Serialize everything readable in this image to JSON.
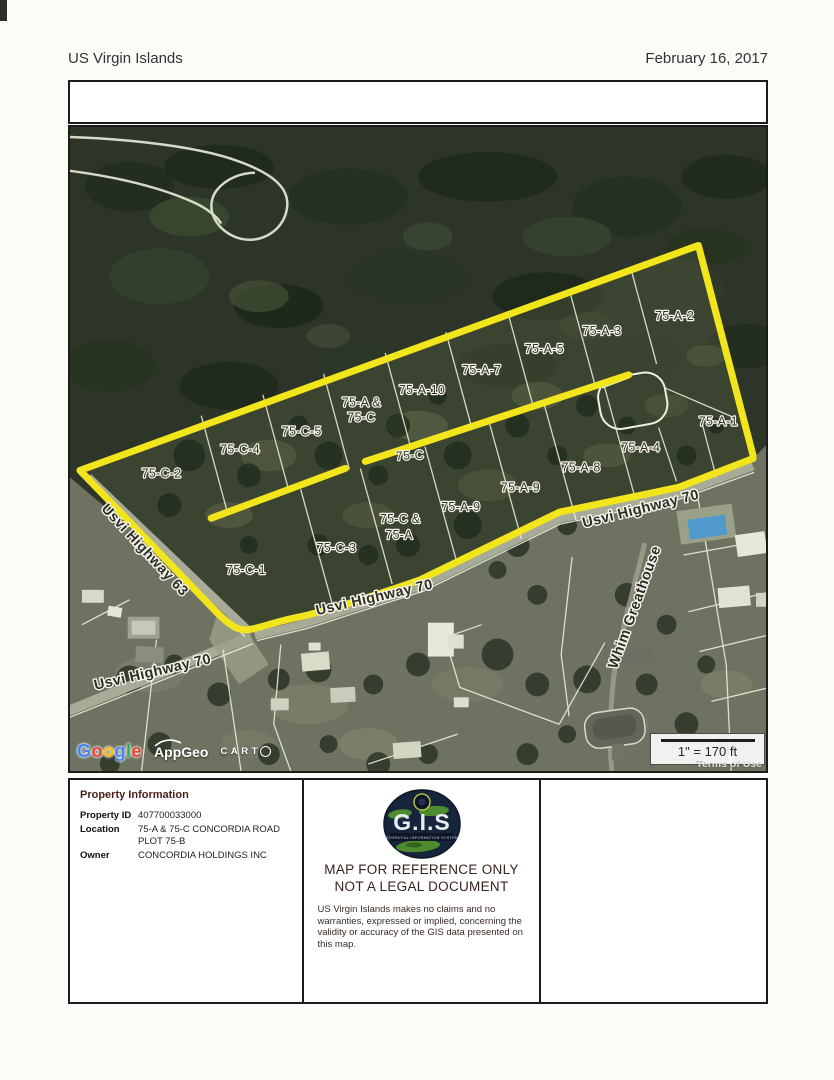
{
  "header": {
    "left": "US Virgin Islands",
    "right": "February 16, 2017"
  },
  "map": {
    "labels": [
      {
        "type": "parcel",
        "text": "75-C-2",
        "x": 92,
        "y": 352,
        "rot": 0
      },
      {
        "type": "parcel",
        "text": "75-C-4",
        "x": 171,
        "y": 328,
        "rot": 0
      },
      {
        "type": "parcel",
        "text": "75-C-5",
        "x": 233,
        "y": 310,
        "rot": 0
      },
      {
        "type": "parcel",
        "text": "75-A &",
        "x": 293,
        "y": 281,
        "rot": 0
      },
      {
        "type": "parcel",
        "text": "75-C",
        "x": 293,
        "y": 296,
        "rot": 0
      },
      {
        "type": "parcel",
        "text": "75-A-10",
        "x": 354,
        "y": 268,
        "rot": 0
      },
      {
        "type": "parcel",
        "text": "75-A-7",
        "x": 414,
        "y": 248,
        "rot": 0
      },
      {
        "type": "parcel",
        "text": "75-A-5",
        "x": 477,
        "y": 227,
        "rot": 0
      },
      {
        "type": "parcel",
        "text": "75-A-3",
        "x": 535,
        "y": 209,
        "rot": 0
      },
      {
        "type": "parcel",
        "text": "75-A-2",
        "x": 608,
        "y": 194,
        "rot": 0
      },
      {
        "type": "parcel",
        "text": "75-A-1",
        "x": 652,
        "y": 300,
        "rot": 0
      },
      {
        "type": "parcel",
        "text": "75-C",
        "x": 342,
        "y": 334,
        "rot": -3
      },
      {
        "type": "parcel",
        "text": "75-C-1",
        "x": 177,
        "y": 449,
        "rot": 0
      },
      {
        "type": "parcel",
        "text": "75-C-3",
        "x": 268,
        "y": 427,
        "rot": 0
      },
      {
        "type": "parcel",
        "text": "75-C &",
        "x": 332,
        "y": 398,
        "rot": 0
      },
      {
        "type": "parcel",
        "text": "75-A",
        "x": 331,
        "y": 414,
        "rot": 0
      },
      {
        "type": "parcel",
        "text": "75-A-9",
        "x": 393,
        "y": 386,
        "rot": 0
      },
      {
        "type": "parcel",
        "text": "75-A-9",
        "x": 453,
        "y": 366,
        "rot": 0
      },
      {
        "type": "parcel",
        "text": "75-A-8",
        "x": 514,
        "y": 346,
        "rot": 0
      },
      {
        "type": "parcel",
        "text": "75-A-4",
        "x": 574,
        "y": 326,
        "rot": 0
      },
      {
        "type": "road",
        "text": "Usvi Highway 63",
        "x": 72,
        "y": 428,
        "rot": 47
      },
      {
        "type": "road",
        "text": "Usvi Highway 70",
        "x": 575,
        "y": 388,
        "rot": -14
      },
      {
        "type": "road",
        "text": "Usvi Highway 70",
        "x": 307,
        "y": 477,
        "rot": -13
      },
      {
        "type": "road",
        "text": "Usvi Highway 70",
        "x": 84,
        "y": 552,
        "rot": -13
      },
      {
        "type": "road",
        "text": "Whim Greathouse",
        "x": 572,
        "y": 484,
        "rot": -70
      }
    ],
    "attribution": {
      "google_letters": [
        {
          "ch": "G",
          "c": "#4285F4"
        },
        {
          "ch": "o",
          "c": "#EA4335"
        },
        {
          "ch": "o",
          "c": "#FBBC05"
        },
        {
          "ch": "g",
          "c": "#4285F4"
        },
        {
          "ch": "l",
          "c": "#34A853"
        },
        {
          "ch": "e",
          "c": "#EA4335"
        }
      ],
      "appgeo": "AppGeo",
      "carto": "CARTO"
    },
    "scale_label": "1\" = 170 ft",
    "terms": "Terms of Use",
    "highlight_color": "#f2e51c"
  },
  "property_info": {
    "title": "Property Information",
    "rows": [
      {
        "label": "Property ID",
        "value": "407700033000"
      },
      {
        "label": "Location",
        "value": "75-A & 75-C CONCORDIA ROAD PLOT 75-B"
      },
      {
        "label": "Owner",
        "value": "CONCORDIA HOLDINGS INC"
      }
    ]
  },
  "notice": {
    "logo_text": "G.I.S",
    "logo_subtext": "GEOSPATIAL INFORMATION SYSTEMS",
    "line1": "MAP FOR REFERENCE ONLY",
    "line2": "NOT A LEGAL DOCUMENT",
    "disclaimer": "US Virgin Islands makes no claims and no warranties, expressed or implied, concerning the validity or accuracy of the GIS data presented on this map."
  }
}
